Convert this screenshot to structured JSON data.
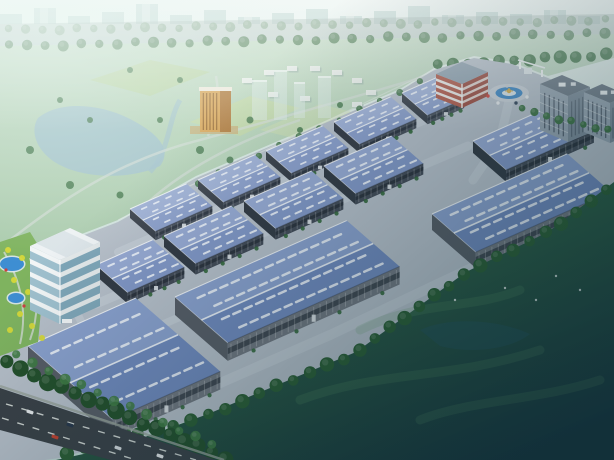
{
  "scene": {
    "description": "Aerial architectural rendering of an industrial logistics park with rows of blue-roofed warehouses, office tower, entrance roundabout and surrounding parkland",
    "canvas": {
      "width": 614,
      "height": 460
    },
    "axes": {
      "a_deg": -24,
      "b_deg": 41
    },
    "palette": {
      "sky_top": "#e9f3ef",
      "sky_bot": "#bed6d0",
      "city_sil": "#a4c4c0",
      "city_white": "#e8f0ec",
      "park_top": "#c3dbc5",
      "park_bot": "#a7c9aa",
      "field1": "#c6daa4",
      "field2": "#b9d298",
      "field3": "#cfe0b0",
      "water": "#a2c2cc",
      "park_road": "#d2dcd4",
      "res_block": "#ecefec",
      "res_shadow": "#9ab0a8",
      "tower_front": "#d9a455",
      "tower_side": "#b0793a",
      "tower_stripe": "#8a5c28",
      "tower_top": "#efe9dc",
      "podium": "#c8b07a",
      "ghost": "#dfeeea",
      "tree_haze": "#7fa184",
      "tree_mid": "#4e7d54",
      "tree_dark": "#3f7246",
      "tree_deep": "#2a5c32",
      "tree_deep2": "#234f2a",
      "tree_bright": "#3f7a42",
      "highway": "#9fb4ad",
      "apron": "#b7bfc9",
      "road_light": "#c3cad3",
      "fence": "#e4ebe6",
      "skylight": "#e9eef7",
      "bush": "#33663a",
      "grass": "#7fb35f",
      "tree_yellow": "#d6d838",
      "flower": "#cc4040",
      "pond": "#3e8ed2",
      "garden_path": "#cfd8d0",
      "office_glass_l": "#9fc0ce",
      "office_glass_r": "#7fa6b8",
      "office_white": "#f2f5f6",
      "office_band_r": "#e4e9ea",
      "red_wall": "#b05848",
      "red_wall2": "#9a4a3e",
      "red_band": "#eef0ee",
      "red_roof": "#8fa0ae",
      "ring_road": "#c9cfd7",
      "pool": "#3e86c4",
      "island": "#d9e4ea",
      "gold": "#cf9f35",
      "gold2": "#d8b050",
      "dorm_l": "#98a5b2",
      "dorm_r": "#7e8c9a",
      "dorm_roof": "#6a7683",
      "dorm_win": "#4d5866",
      "dorm_white": "#eef2f4",
      "ghost_green": "#5d9a66",
      "ghost_lake": "#224f58",
      "asphalt": "#3a4046",
      "sidewalk": "#98a29a",
      "lane": "#dfe3df"
    },
    "tones": {
      "back": {
        "roofL": "#9fb0d6",
        "roofD": "#8c9fcb",
        "wall": "#49505c",
        "end": "#383e48",
        "band": "#2e3440",
        "lw": 1.1,
        "sl": 2.6,
        "sw": 1.7
      },
      "mid": {
        "roofL": "#97a9d2",
        "roofD": "#8297c6",
        "wall": "#434a56",
        "end": "#333a44",
        "band": "#2a303a",
        "lw": 1.3,
        "sl": 3.1,
        "sw": 2.0
      },
      "front": {
        "roofL": "#8aa0cd",
        "roofD": "#7089bd",
        "wall": "#71767f",
        "end": "#575c65",
        "band": "#3a4049",
        "lw": 1.6,
        "sl": 3.8,
        "sw": 2.5
      }
    },
    "warehouses": [
      {
        "x": 130,
        "y": 209,
        "l": 62,
        "d": 34,
        "h": 9,
        "t": "back"
      },
      {
        "x": 198,
        "y": 180,
        "l": 62,
        "d": 34,
        "h": 9,
        "t": "back"
      },
      {
        "x": 266,
        "y": 151,
        "l": 62,
        "d": 34,
        "h": 9,
        "t": "back"
      },
      {
        "x": 334,
        "y": 122,
        "l": 62,
        "d": 34,
        "h": 9,
        "t": "back"
      },
      {
        "x": 402,
        "y": 93,
        "l": 40,
        "d": 34,
        "h": 9,
        "t": "back"
      },
      {
        "x": 96,
        "y": 265,
        "l": 62,
        "d": 42,
        "h": 11,
        "t": "mid"
      },
      {
        "x": 164,
        "y": 236,
        "l": 74,
        "d": 42,
        "h": 11,
        "t": "mid"
      },
      {
        "x": 244,
        "y": 201,
        "l": 74,
        "d": 42,
        "h": 11,
        "t": "mid"
      },
      {
        "x": 324,
        "y": 166,
        "l": 74,
        "d": 42,
        "h": 11,
        "t": "mid"
      },
      {
        "x": 473,
        "y": 141,
        "l": 96,
        "d": 44,
        "h": 12,
        "t": "mid"
      },
      {
        "x": 432,
        "y": 214,
        "l": 148,
        "d": 58,
        "h": 16,
        "t": "front"
      },
      {
        "x": 175,
        "y": 297,
        "l": 188,
        "d": 70,
        "h": 18,
        "t": "front"
      },
      {
        "x": 28,
        "y": 346,
        "l": 118,
        "d": 112,
        "h": 18,
        "t": "front"
      }
    ],
    "city_skyline": {
      "baseline": 24,
      "step": 34,
      "bar_w": 22,
      "heights": [
        10,
        16,
        8,
        12,
        20,
        9,
        14,
        7,
        11,
        15,
        8,
        13,
        18,
        9,
        12,
        10,
        14,
        8
      ]
    },
    "sheds": [
      [
        28,
        70,
        14,
        7
      ],
      [
        46,
        76,
        12,
        6
      ],
      [
        8,
        84,
        10,
        6
      ]
    ],
    "highway_band": [
      [
        0,
        24
      ],
      [
        614,
        14
      ],
      [
        614,
        34
      ],
      [
        0,
        46
      ]
    ],
    "tree_rows": [
      {
        "name": "highway-far-trees",
        "pts": [
          [
            0,
            30
          ],
          [
            614,
            20
          ]
        ],
        "n": 36,
        "r": 4.5,
        "fill": "tree_haze",
        "op": 0.75
      },
      {
        "name": "highway-near-trees",
        "pts": [
          [
            0,
            46
          ],
          [
            614,
            33
          ]
        ],
        "n": 34,
        "r": 5,
        "fill": "tree_mid",
        "op": 0.85
      },
      {
        "name": "entrance-back-trees",
        "pts": [
          [
            430,
            66
          ],
          [
            614,
            54
          ]
        ],
        "n": 12,
        "r": 6,
        "fill": "tree_dark",
        "op": 0.95
      },
      {
        "name": "park-boundary-trees",
        "pts": [
          [
            128,
            214
          ],
          [
            430,
            78
          ]
        ],
        "n": 15,
        "r": 3.2,
        "fill": "tree_dark",
        "op": 0.9
      },
      {
        "name": "dorm-front-trees",
        "pts": [
          [
            516,
            108
          ],
          [
            614,
            132
          ]
        ],
        "n": 8,
        "r": 4,
        "fill": "tree_dark",
        "op": 1
      },
      {
        "name": "se-boundary-trees",
        "pts": [
          [
            614,
            186
          ],
          [
            544,
            234
          ],
          [
            464,
            274
          ],
          [
            354,
            354
          ],
          [
            206,
            416
          ],
          [
            58,
            456
          ]
        ],
        "n": 34,
        "r": 6.5,
        "fill": "tree_deep",
        "op": 1
      },
      {
        "name": "bottom-belt-trees",
        "pts": [
          [
            0,
            360
          ],
          [
            232,
            462
          ]
        ],
        "n": 17,
        "r": 8,
        "fill": "tree_deep2",
        "op": 1
      },
      {
        "name": "bottom-belt-trees-2",
        "pts": [
          [
            8,
            352
          ],
          [
            220,
            448
          ]
        ],
        "n": 13,
        "r": 5,
        "fill": "tree_bright",
        "op": 0.9
      }
    ],
    "parkland": {
      "outline": [
        [
          0,
          46
        ],
        [
          614,
          34
        ],
        [
          614,
          58
        ],
        [
          548,
          76
        ],
        [
          512,
          62
        ],
        [
          474,
          56
        ],
        [
          434,
          68
        ],
        [
          400,
          89
        ],
        [
          332,
          118
        ],
        [
          264,
          147
        ],
        [
          196,
          176
        ],
        [
          118,
          220
        ],
        [
          40,
          250
        ],
        [
          0,
          290
        ]
      ],
      "lake": "M38,118 C60,100 100,104 128,118 C160,134 172,150 160,166 C130,180 86,178 62,166 C40,156 28,134 38,118 Z",
      "stream": "M150,172 C170,150 168,120 180,100",
      "fields": [
        {
          "pts": [
            [
              190,
              122
            ],
            [
              250,
              96
            ],
            [
              300,
              108
            ],
            [
              240,
              136
            ]
          ],
          "fill": "field1",
          "op": 0.7
        },
        {
          "pts": [
            [
              90,
              80
            ],
            [
              150,
              60
            ],
            [
              210,
              72
            ],
            [
              150,
              96
            ]
          ],
          "fill": "field2",
          "op": 0.6
        },
        {
          "pts": [
            [
              260,
              130
            ],
            [
              320,
              104
            ],
            [
              368,
              116
            ],
            [
              310,
              142
            ]
          ],
          "fill": "field3",
          "op": 0.5
        }
      ],
      "roads": [
        "M0,248 C60,200 120,160 200,140 C280,118 360,96 440,72",
        "M140,210 C180,170 240,140 300,120",
        "M208,136 C216,112 220,96 216,76"
      ],
      "residential_blocks": [
        [
          242,
          78
        ],
        [
          264,
          70
        ],
        [
          287,
          66
        ],
        [
          310,
          66
        ],
        [
          332,
          70
        ],
        [
          352,
          78
        ],
        [
          366,
          90
        ],
        [
          352,
          102
        ],
        [
          300,
          96
        ],
        [
          268,
          92
        ]
      ],
      "yellow_tower": {
        "podium": [
          190,
          126,
          48,
          8
        ],
        "front": [
          200,
          90,
          20,
          42
        ],
        "side": [
          220,
          90,
          11,
          42
        ],
        "cap": [
          199,
          87,
          33,
          4
        ],
        "stripes": 5
      },
      "ghost_towers": [
        [
          252,
          80,
          15,
          40
        ],
        [
          274,
          70,
          13,
          50
        ],
        [
          294,
          82,
          11,
          36
        ],
        [
          318,
          76,
          13,
          42
        ]
      ],
      "trees": [
        [
          30,
          150,
          4
        ],
        [
          70,
          185,
          4
        ],
        [
          120,
          195,
          3.5
        ],
        [
          160,
          120,
          3
        ],
        [
          200,
          150,
          4
        ],
        [
          90,
          120,
          3
        ],
        [
          250,
          120,
          3.5
        ],
        [
          300,
          130,
          3
        ],
        [
          340,
          105,
          3
        ],
        [
          180,
          80,
          3
        ],
        [
          130,
          70,
          3
        ],
        [
          60,
          100,
          3
        ],
        [
          230,
          160,
          3.5
        ],
        [
          280,
          150,
          3
        ]
      ]
    },
    "apron": {
      "outline": [
        [
          0,
          462
        ],
        [
          0,
          290
        ],
        [
          40,
          252
        ],
        [
          118,
          222
        ],
        [
          196,
          178
        ],
        [
          264,
          149
        ],
        [
          332,
          120
        ],
        [
          400,
          91
        ],
        [
          434,
          70
        ],
        [
          474,
          58
        ],
        [
          512,
          64
        ],
        [
          548,
          78
        ],
        [
          582,
          94
        ],
        [
          614,
          110
        ],
        [
          614,
          188
        ],
        [
          544,
          236
        ],
        [
          464,
          274
        ],
        [
          354,
          354
        ],
        [
          206,
          416
        ],
        [
          60,
          458
        ],
        [
          30,
          462
        ]
      ],
      "roads": [
        {
          "pts": [
            [
              118,
              252
            ],
            [
              430,
              118
            ]
          ],
          "w": 8
        },
        {
          "pts": [
            [
              96,
              304
            ],
            [
              468,
              146
            ]
          ],
          "w": 9
        },
        {
          "pts": [
            [
              150,
              330
            ],
            [
              230,
              295
            ]
          ],
          "w": 8
        },
        {
          "pts": [
            [
              52,
              262
            ],
            [
              96,
              352
            ]
          ],
          "w": 8
        },
        {
          "pts": [
            [
              90,
              440
            ],
            [
              330,
              335
            ],
            [
              520,
              245
            ]
          ],
          "w": 10
        },
        {
          "pts": [
            [
              509,
              101
            ],
            [
              500,
              140
            ],
            [
              473,
              180
            ]
          ],
          "w": 9
        },
        {
          "pts": [
            [
              489,
              93
            ],
            [
              430,
              110
            ]
          ],
          "w": 7
        }
      ],
      "fence": [
        [
          118,
          220
        ],
        [
          436,
          69
        ]
      ]
    },
    "office_tower": {
      "t0": [
        30,
        246
      ],
      "wa": [
        40,
        -18
      ],
      "wb": [
        30,
        14
      ],
      "h": 64,
      "floors": 5
    },
    "garden": {
      "outline": [
        [
          0,
          242
        ],
        [
          30,
          232
        ],
        [
          46,
          258
        ],
        [
          38,
          342
        ],
        [
          0,
          356
        ]
      ],
      "ponds": [
        {
          "cx": 12,
          "cy": 264,
          "rx": 12,
          "ry": 7
        },
        {
          "cx": 16,
          "cy": 298,
          "rx": 8,
          "ry": 5
        }
      ],
      "paths": [
        "M4,252 C20,280 28,310 20,344",
        "M30,258 C40,290 38,318 30,340"
      ],
      "yellow_trees": [
        [
          8,
          250
        ],
        [
          22,
          258
        ],
        [
          34,
          268
        ],
        [
          14,
          280
        ],
        [
          28,
          292
        ],
        [
          38,
          304
        ],
        [
          20,
          314
        ],
        [
          32,
          326
        ],
        [
          42,
          338
        ],
        [
          10,
          330
        ]
      ],
      "flowers": [
        [
          6,
          270
        ],
        [
          24,
          306
        ]
      ]
    },
    "entrance": {
      "red_office": {
        "t0": [
          436,
          74
        ],
        "wa": [
          26,
          -12
        ],
        "wb": [
          26,
          10
        ],
        "h": 24
      },
      "roundabout": {
        "cx": 509,
        "cy": 93,
        "outer_rx": 20,
        "outer_ry": 9,
        "pool_rx": 13.5,
        "pool_ry": 6,
        "island_rx": 7,
        "island_ry": 3
      },
      "gate": {
        "canopy": [
          [
            518,
            60
          ],
          [
            545,
            68
          ]
        ],
        "posts": [
          [
            520,
            62
          ],
          [
            542,
            70
          ]
        ],
        "booth": [
          524,
          68,
          8,
          6
        ]
      },
      "dorms": [
        {
          "t0": [
            540,
            84
          ],
          "wa": [
            22,
            -9
          ],
          "wb": [
            28,
            12
          ],
          "h": 46
        },
        {
          "t0": [
            584,
            92
          ],
          "wa": [
            18,
            -8
          ],
          "wb": [
            26,
            11
          ],
          "h": 40
        }
      ],
      "vehicles": [
        [
          488,
          96,
          "#d04038"
        ],
        [
          498,
          103,
          "#e8eaec"
        ],
        [
          516,
          103,
          "#324258"
        ],
        [
          527,
          97,
          "#e8eaec"
        ],
        [
          507,
          86,
          "#c8ccd2"
        ]
      ]
    },
    "meadow": {
      "outline": [
        [
          614,
          182
        ],
        [
          548,
          232
        ],
        [
          466,
          272
        ],
        [
          356,
          352
        ],
        [
          208,
          414
        ],
        [
          120,
          446
        ],
        [
          56,
          460
        ],
        [
          614,
          460
        ]
      ],
      "ghost_paths": [
        "M360,330 C420,300 470,310 520,290",
        "M300,400 C380,370 450,380 540,350",
        "M420,420 C470,400 540,400 600,380"
      ],
      "ghost_lake": "M420,330 c30,-14 80,-10 110,4 c-20,16 -60,20 -90,12 z",
      "dots": [
        [
          455,
          300
        ],
        [
          505,
          288
        ],
        [
          556,
          276
        ],
        [
          536,
          300
        ],
        [
          580,
          290
        ]
      ]
    },
    "city_road": {
      "outline": [
        [
          0,
          388
        ],
        [
          222,
          462
        ],
        [
          118,
          462
        ],
        [
          0,
          430
        ]
      ],
      "sidewalk": [
        [
          0,
          386
        ],
        [
          224,
          460
        ]
      ],
      "lanes": [
        [
          [
            6,
            404
          ],
          [
            196,
            460
          ]
        ],
        [
          [
            2,
            418
          ],
          [
            136,
            460
          ]
        ]
      ],
      "cars": [
        [
          30,
          412,
          "#e9ebed"
        ],
        [
          70,
          425,
          "#27364a"
        ],
        [
          55,
          437,
          "#c2402f"
        ],
        [
          118,
          448,
          "#d8dce0"
        ],
        [
          160,
          456,
          "#e9ebed"
        ]
      ]
    }
  }
}
